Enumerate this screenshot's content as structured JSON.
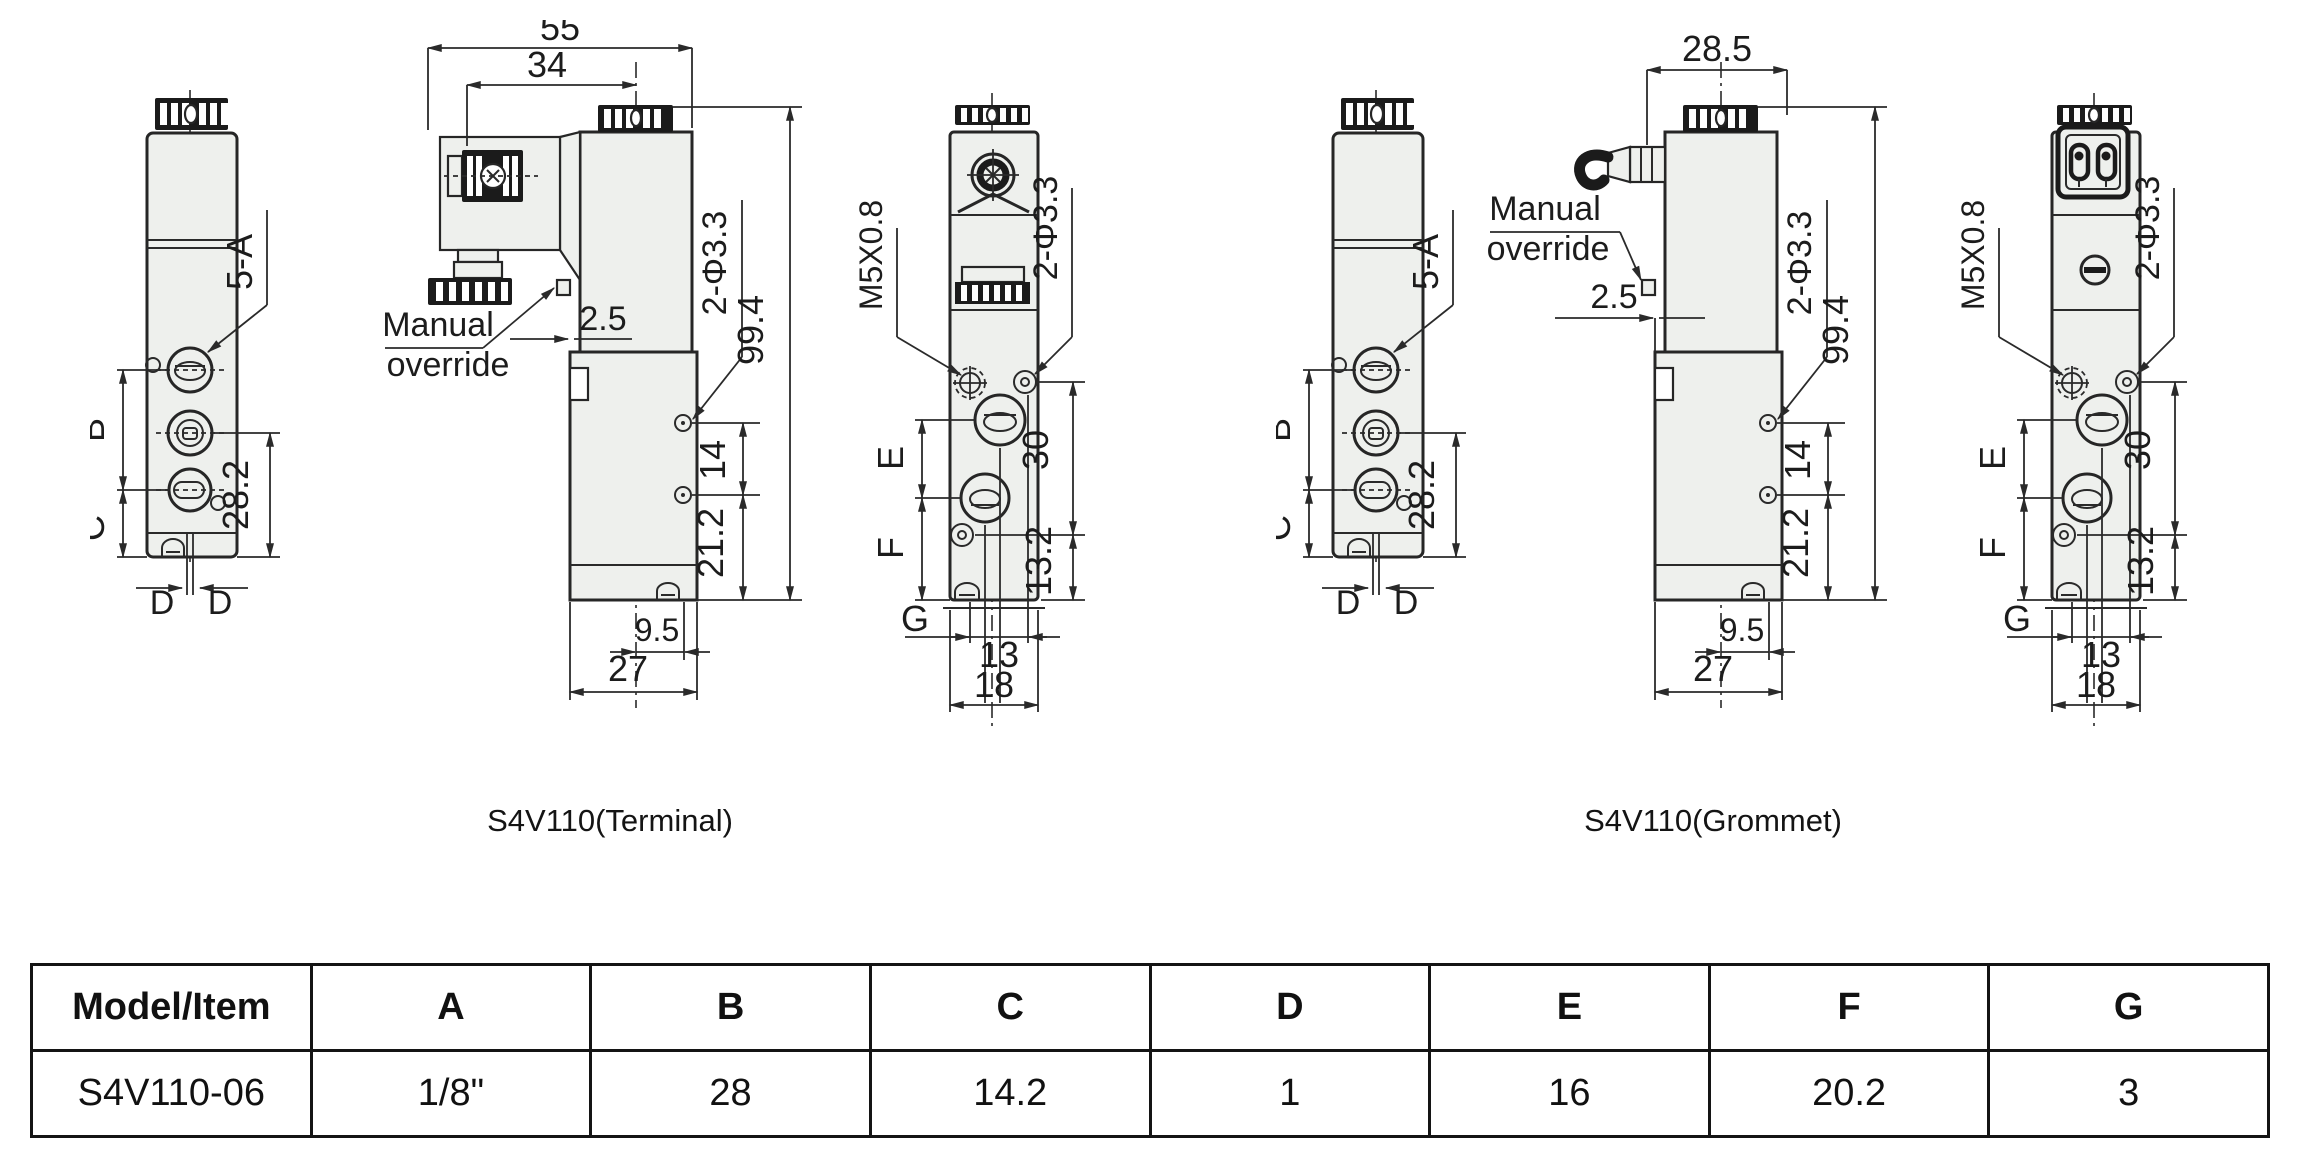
{
  "page": {
    "background": "#ffffff",
    "line_color": "#2a2a2a",
    "body_fill": "#eef0ed",
    "dark_fill": "#1b1b1b"
  },
  "captions": {
    "terminal": "S4V110(Terminal)",
    "grommet": "S4V110(Grommet)"
  },
  "labels": {
    "front": {
      "five_a": "5-A",
      "b": "B",
      "c": "C",
      "d_left": "D",
      "d_right": "D",
      "h28_2": "28.2"
    },
    "side": {
      "holes": "2-Φ3.3",
      "h99_4": "99.4",
      "h14": "14",
      "h21_2": "21.2",
      "h9_5": "9.5",
      "h27": "27",
      "manual1": "Manual",
      "manual2": "override",
      "h2_5": "2.5"
    },
    "side_terminal": {
      "h55": "55",
      "h34": "34"
    },
    "side_grommet": {
      "h28_5": "28.5"
    },
    "end": {
      "thread": "M5X0.8",
      "holes": "2-Φ3.3",
      "e": "E",
      "f": "F",
      "g": "G",
      "h30": "30",
      "h13_2": "13.2",
      "h13": "13",
      "h18": "18"
    }
  },
  "table": {
    "headers": [
      "Model/Item",
      "A",
      "B",
      "C",
      "D",
      "E",
      "F",
      "G"
    ],
    "rows": [
      [
        "S4V110-06",
        "1/8\"",
        "28",
        "14.2",
        "1",
        "16",
        "20.2",
        "3"
      ]
    ]
  }
}
